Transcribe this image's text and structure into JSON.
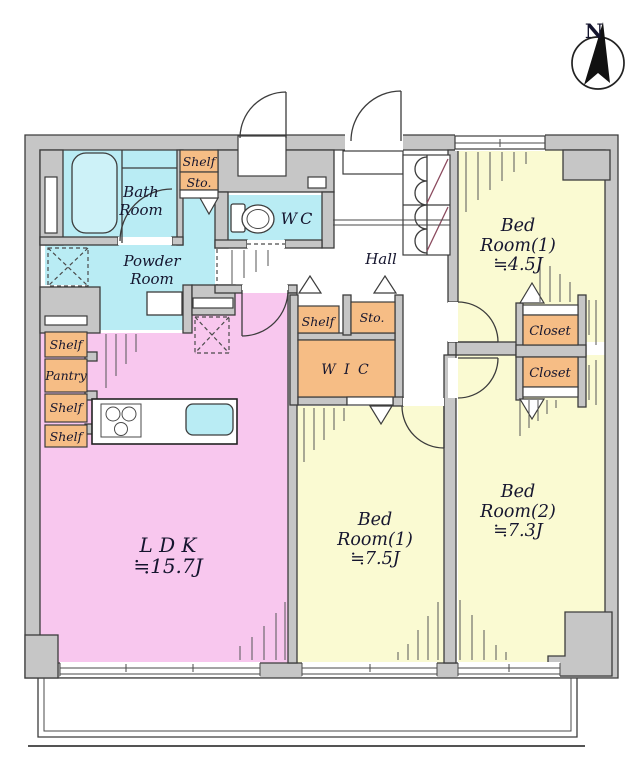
{
  "meta": {
    "type": "apartment-floor-plan"
  },
  "compass": {
    "north_label": "N"
  },
  "rooms": {
    "bath": {
      "line1": "Bath",
      "line2": "Room"
    },
    "powder": {
      "line1": "Powder",
      "line2": "Room"
    },
    "wc": {
      "label": "WC"
    },
    "hall": {
      "label": "Hall"
    },
    "bedroom1a": {
      "line1": "Bed",
      "line2": "Room(1)",
      "line3": "≒4.5J"
    },
    "bedroom1b": {
      "line1": "Bed",
      "line2": "Room(1)",
      "line3": "≒7.5J"
    },
    "bedroom2": {
      "line1": "Bed",
      "line2": "Room(2)",
      "line3": "≒7.3J"
    },
    "ldk": {
      "line1": "L D K",
      "line2": "≒15.7J"
    },
    "wic": {
      "label": "W I C"
    }
  },
  "storage_labels": {
    "shelf": "Shelf",
    "sto": "Sto.",
    "pantry": "Pantry",
    "closet": "Closet"
  },
  "colors": {
    "wall_fill": "#c6c6c6",
    "wall_line": "#3c3c3c",
    "wet_area": "#b9ecf4",
    "tub": "#cdf2f8",
    "ldk": "#f8c7ee",
    "bedroom": "#fafad2",
    "storage": "#f6bd85",
    "door_accent": "#8b4a5e",
    "text": "#15152e"
  }
}
